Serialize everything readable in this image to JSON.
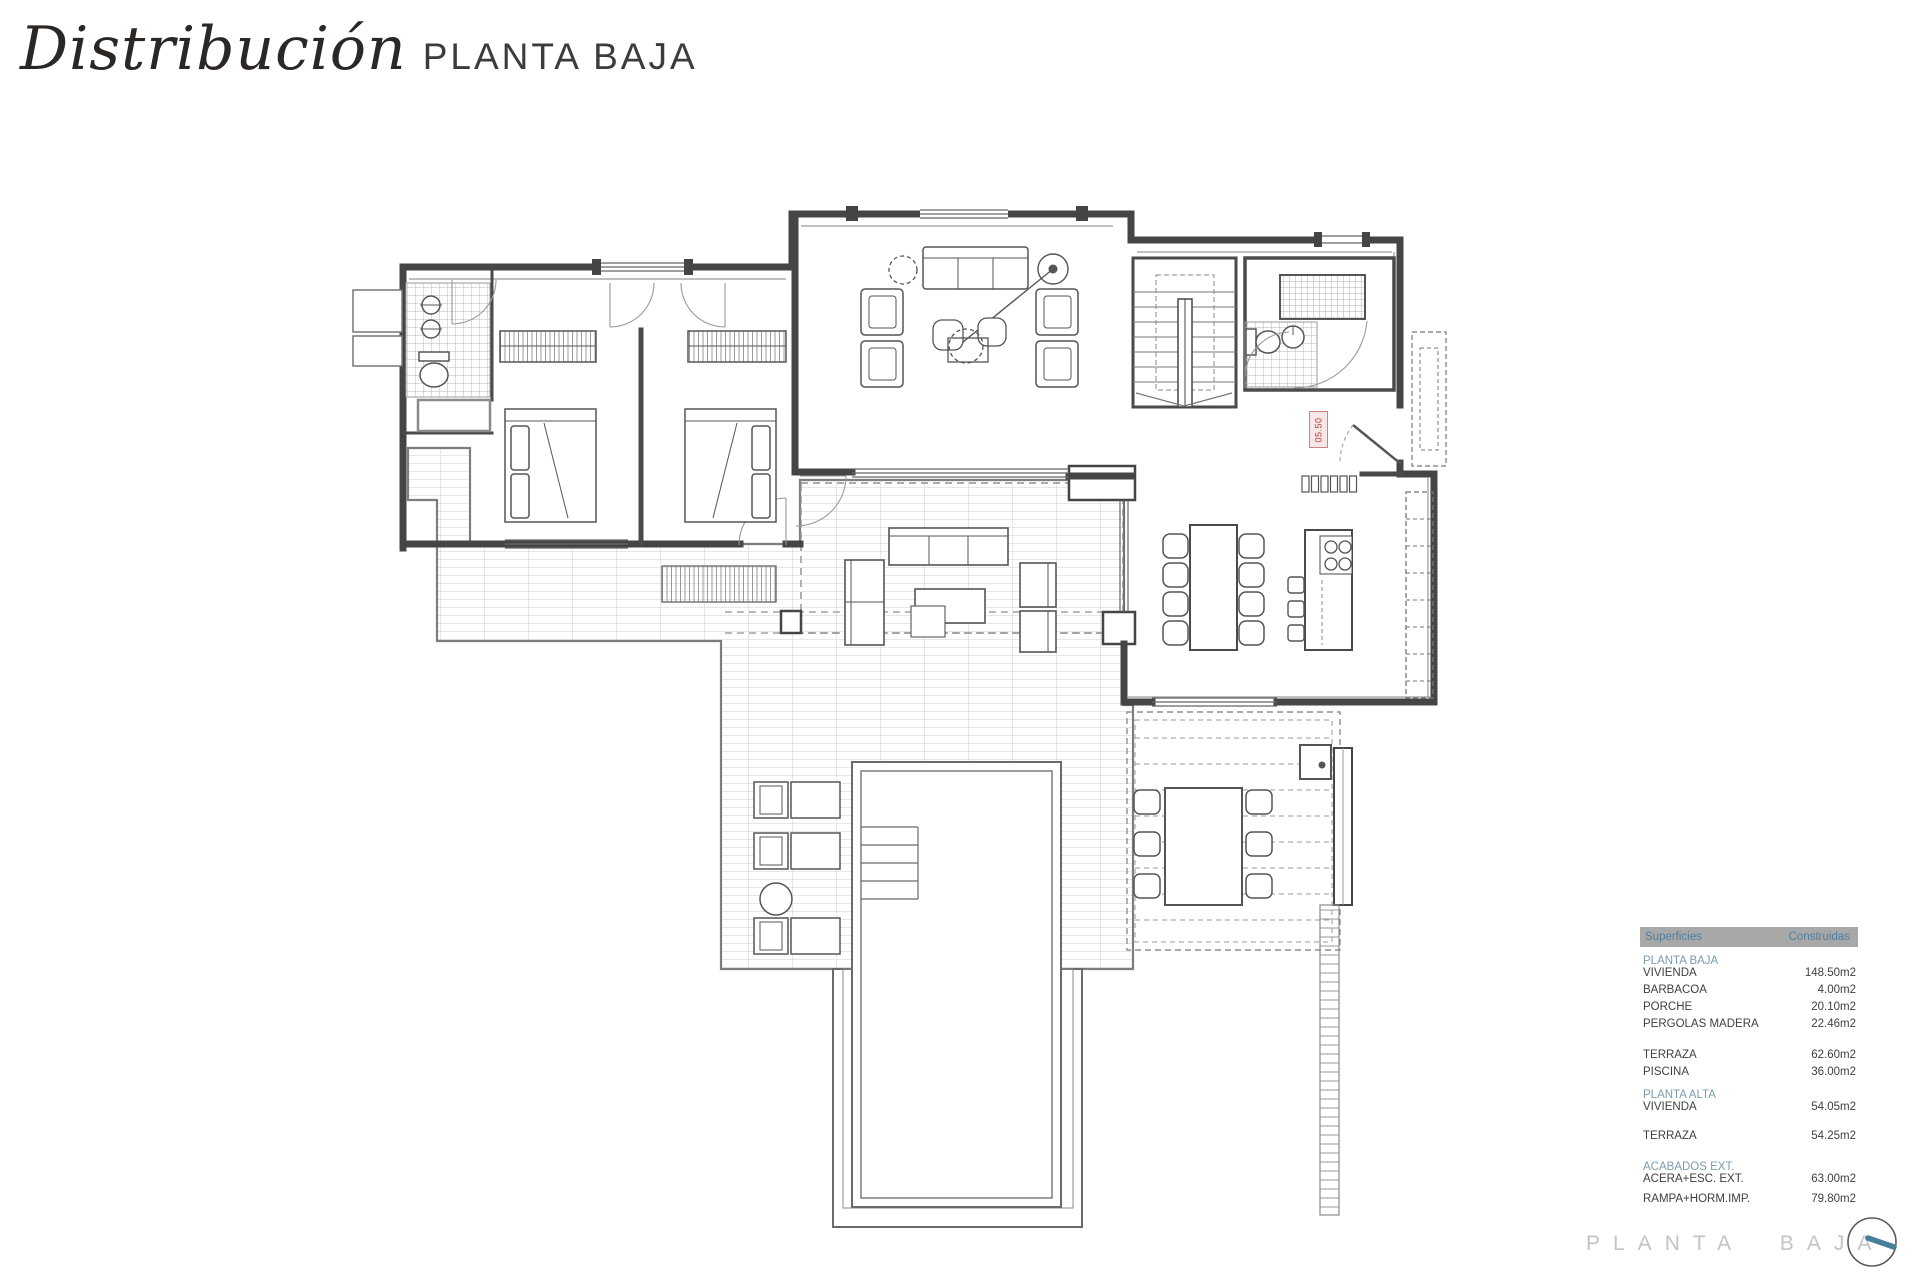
{
  "header": {
    "title": "Distribución",
    "subtitle": "PLANTA BAJA"
  },
  "plan": {
    "room_label": "05.50"
  },
  "surfaces_table": {
    "columns": [
      "Superficies",
      "Construidas"
    ],
    "rows": [
      {
        "label": "PLANTA BAJA",
        "value": "",
        "type": "section"
      },
      {
        "label": "VIVIENDA",
        "value": "148.50m2"
      },
      {
        "label": "BARBACOA",
        "value": "4.00m2"
      },
      {
        "label": "PORCHE",
        "value": "20.10m2"
      },
      {
        "label": "PERGOLAS MADERA",
        "value": "22.46m2"
      },
      {
        "label": "TERRAZA",
        "value": "62.60m2"
      },
      {
        "label": "PISCINA",
        "value": "36.00m2"
      },
      {
        "label": "PLANTA ALTA",
        "value": "",
        "type": "section"
      },
      {
        "label": "VIVIENDA",
        "value": "54.05m2"
      },
      {
        "label": "TERRAZA",
        "value": "54.25m2"
      },
      {
        "label": "ACABADOS EXT.",
        "value": "",
        "type": "section"
      },
      {
        "label": "ACERA+ESC. EXT.",
        "value": "63.00m2"
      },
      {
        "label": "RAMPA+HORM.IMP.",
        "value": "79.80m2"
      }
    ]
  },
  "footer": {
    "label": "PLANTA BAJA"
  },
  "colors": {
    "wall": "#454545",
    "tile_line": "#c9c9c9",
    "section_blue": "#7b9cb0",
    "table_header_text": "#4f7fa0",
    "table_header_bg": "#a8a8a8",
    "row_text": "#3f3f3f",
    "red_label": "#bb3a3a",
    "footer_text": "#c4c4c4",
    "logo_tick": "#4a7d9b"
  }
}
